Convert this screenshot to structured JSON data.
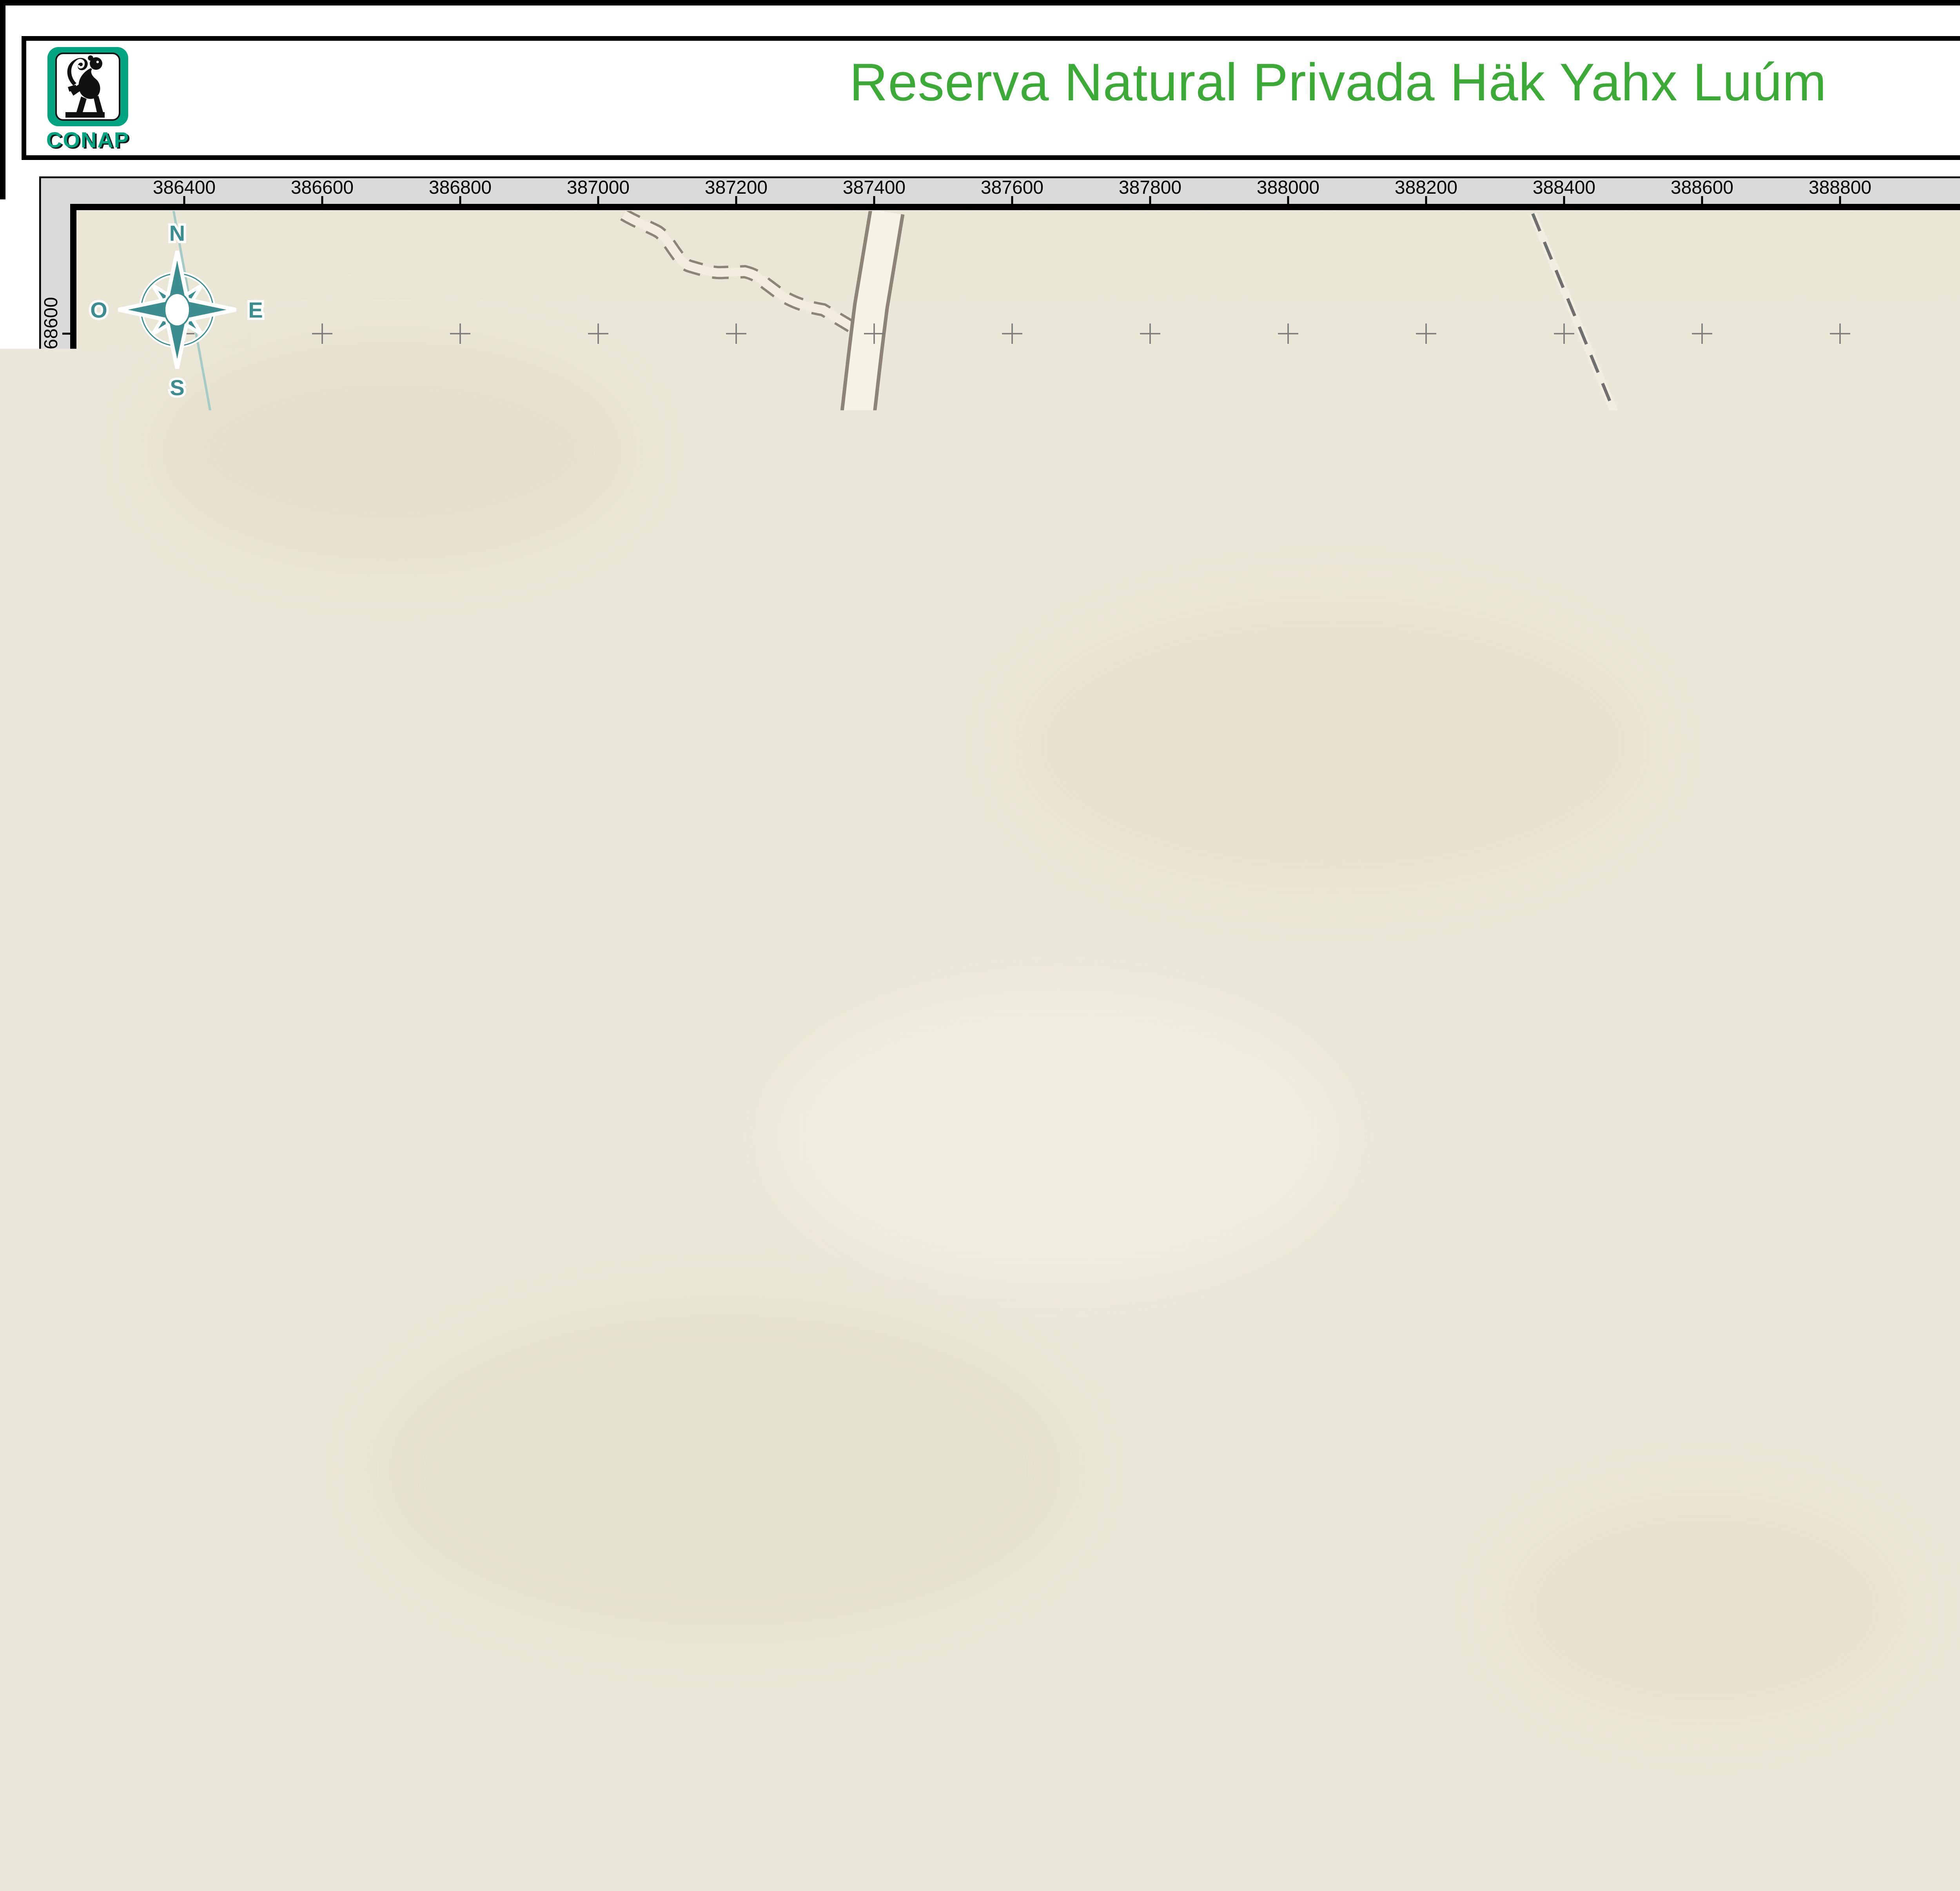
{
  "header": {
    "logo_text": "CONAP",
    "title": "Reserva Natural Privada Häk Yahx Luúm",
    "doc_code": "DAGeos-417-2026-BS"
  },
  "map": {
    "grid": {
      "x_labels": [
        "386400",
        "386600",
        "386800",
        "387000",
        "387200",
        "387400",
        "387600",
        "387800",
        "388000",
        "388200",
        "388400",
        "388600",
        "388800"
      ],
      "y_labels": [
        "1768600",
        "1768400",
        "1768200",
        "1768000",
        "1767800",
        "1767600",
        "1767400",
        "1767200",
        "1767000",
        "1766800",
        "1766600",
        "1766400"
      ]
    },
    "department_label": "HUEHUETENANGO",
    "reserve_label_lines": [
      "Reserva",
      "Natural",
      "Privada Häk",
      "Yahx Luúm"
    ],
    "road_label": "ORTE",
    "compass": {
      "n": "N",
      "e": "E",
      "s": "S",
      "w": "O"
    },
    "scalebar": {
      "labels": [
        "0",
        "0.11",
        "0.22"
      ],
      "end_label": "0.44 Kilómetros"
    }
  },
  "inset": {
    "country_label": "Guatemala",
    "city_label": "Guatemala",
    "city2_label": "San Salvador",
    "belize_fragment": "B",
    "honduras_fragment": "H o",
    "sea_fragment_1": "Gu",
    "sea_fragment_2": "o",
    "sea_fragment_3": "Hond",
    "number_label": "721",
    "note_lines": [
      "Diferendo",
      "territorial no",
      "resuelto"
    ]
  },
  "legend": {
    "title": "Simbología",
    "items": [
      {
        "label": "Límite Departamental",
        "color": "#a6a6a6"
      },
      {
        "label": "Área protegida",
        "color": "#45d41c"
      }
    ]
  },
  "info": {
    "center_lines": [
      "Sistema de coordenadas proyectadas",
      "Proyección GTM",
      "Datum WGS84"
    ],
    "fuente": "Fuente:",
    "source_line_1": "Base de datos de la Dirección Análisis Geoespacial",
    "source_line_2": "CONAP 2026",
    "source_line_3": "Base de datos cartografía básica IGN 2010"
  },
  "colors": {
    "title_green": "#3baa36",
    "protected_green": "#45d41c",
    "limit_gray": "#a6a6a6",
    "conap_teal": "#00a481",
    "guatemala_orange": "#f4b468",
    "map_paper": "#ece8d9",
    "diferendo_red": "#8d1717",
    "marker_red": "#ee1111"
  }
}
